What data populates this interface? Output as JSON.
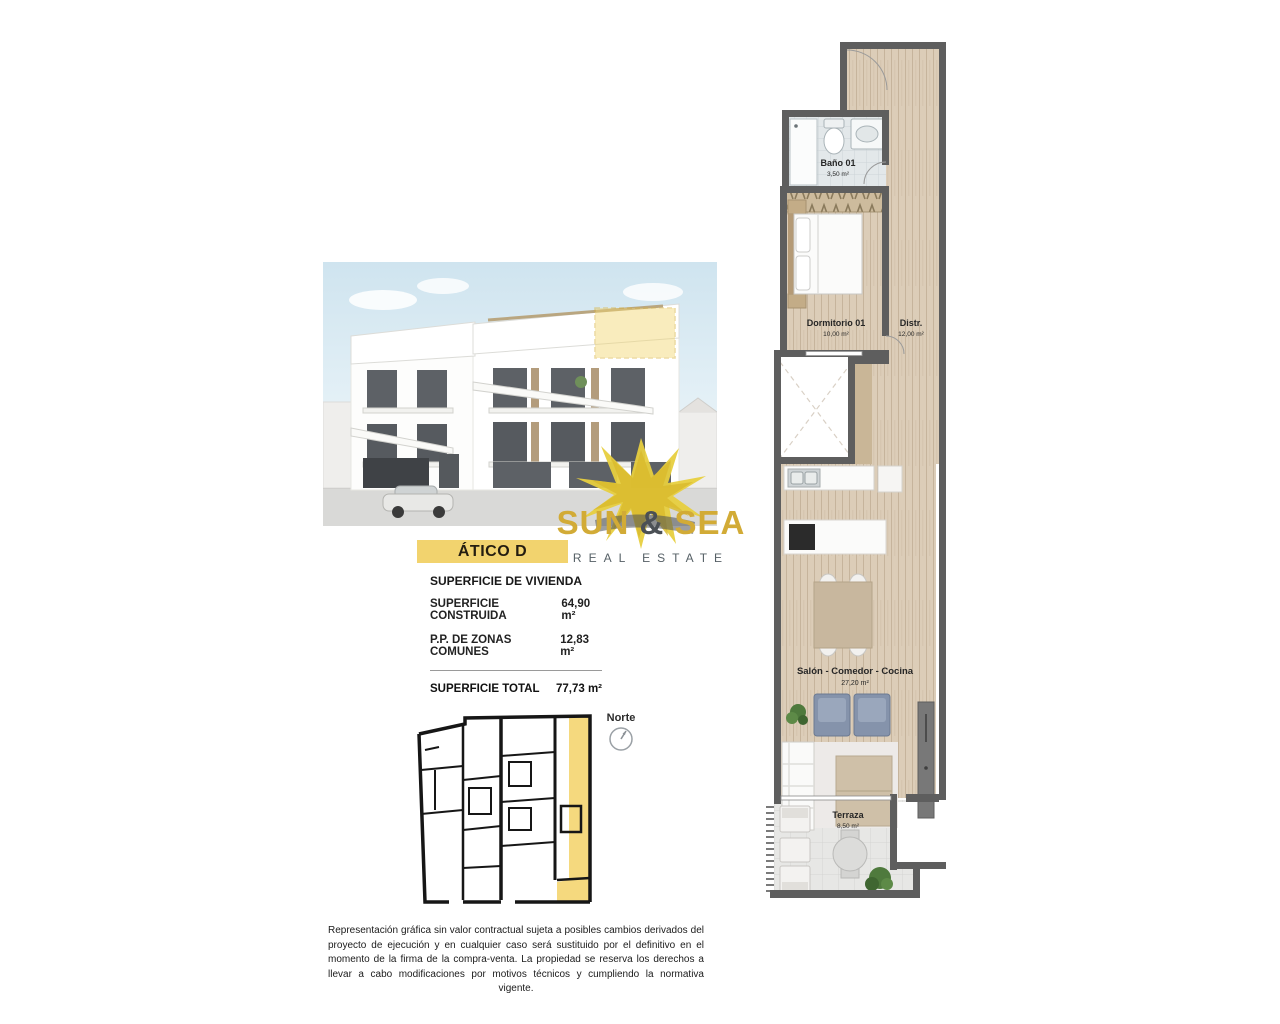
{
  "unit": {
    "title": "ÁTICO D"
  },
  "logo": {
    "sun": "SUN",
    "amp": "&",
    "sea": "SEA",
    "tagline": "REAL ESTATE"
  },
  "surface": {
    "header": "SUPERFICIE DE VIVIENDA",
    "rows": [
      {
        "label": "SUPERFICIE CONSTRUIDA",
        "value": "64,90 m²"
      },
      {
        "label": "P.P. DE ZONAS COMUNES",
        "value": "12,83 m²"
      }
    ],
    "total_label": "SUPERFICIE TOTAL",
    "total_value": "77,73 m²"
  },
  "locator": {
    "compass": "Norte"
  },
  "floorplan": {
    "rooms": [
      {
        "name": "Baño 01",
        "area": "3,50 m²"
      },
      {
        "name": "Dormitorio 01",
        "area": "10,00 m²"
      },
      {
        "name": "Distr.",
        "area": "12,00 m²"
      },
      {
        "name": "Salón - Comedor - Cocina",
        "area": "27,20 m²"
      },
      {
        "name": "Terraza",
        "area": "8,50 m²"
      }
    ]
  },
  "disclaimer": "Representación gráfica sin valor contractual sujeta a posibles cambios derivados del proyecto de ejecución y en cualquier caso será sustituido por el definitivo en el momento de la firma de la compra-venta. La propiedad se reserva los derechos a llevar a cabo modificaciones por motivos técnicos y cumpliendo la normativa vigente.",
  "colors": {
    "accent_yellow": "#F2D36E",
    "highlight_yellow": "#F5D97E",
    "wall_gray": "#5E5E5E",
    "wood": "#DCCDB8",
    "logo_gold": "#D2AB36",
    "logo_gray": "#566066"
  }
}
